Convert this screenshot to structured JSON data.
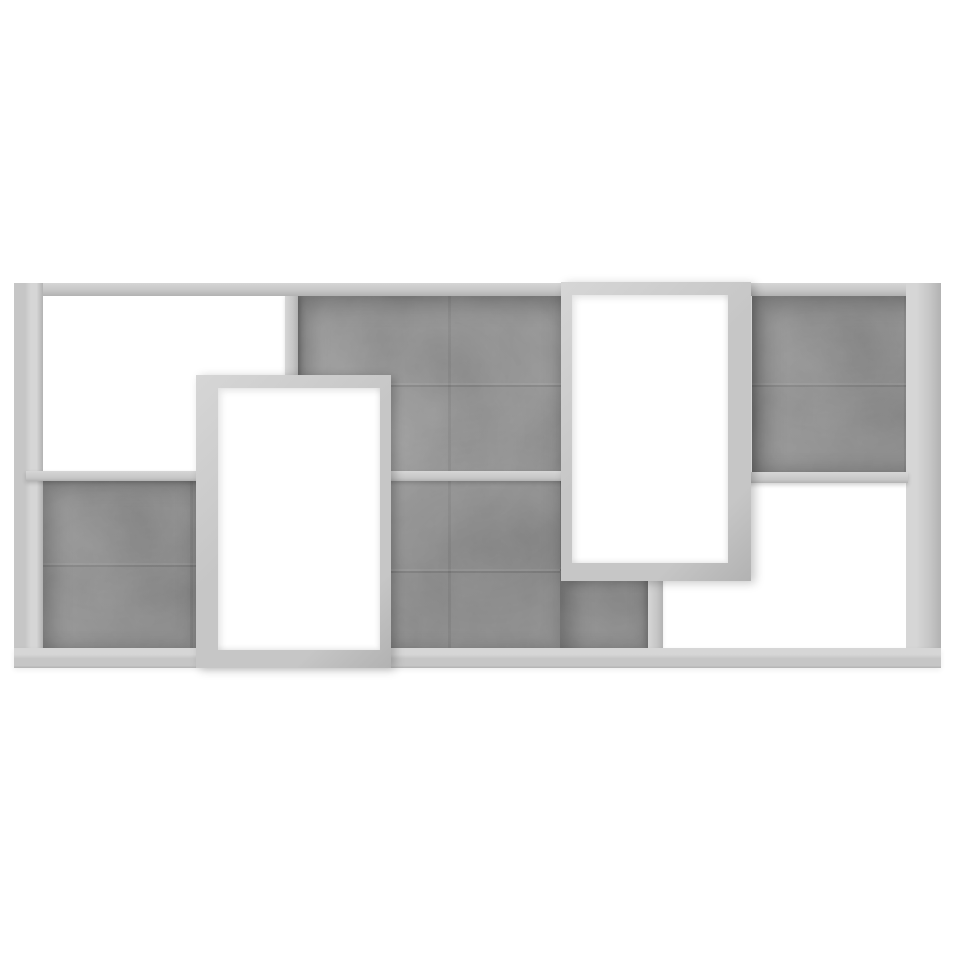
{
  "page": {
    "background_color": "#ffffff"
  },
  "product_image": {
    "description": "Concrete grey geometric wall-mounted shelf with eight staggered compartments, front view on a plain white background",
    "style": "concrete-look engineered wood",
    "compartments": {
      "open_white": [
        "top-left",
        "bottom-right",
        "left-protruding-box",
        "right-protruding-box"
      ],
      "concrete_backed": [
        "bottom-left",
        "center-top",
        "center-bottom",
        "top-right"
      ]
    },
    "colors": {
      "background": "#ffffff",
      "board": "#c6c6c6",
      "board_light": "#d6d6d6",
      "board_dark": "#b2b2b2",
      "panel_base": "#8d8d8d",
      "panel_dark": "#767676",
      "panel_light": "#9e9e9e"
    }
  }
}
